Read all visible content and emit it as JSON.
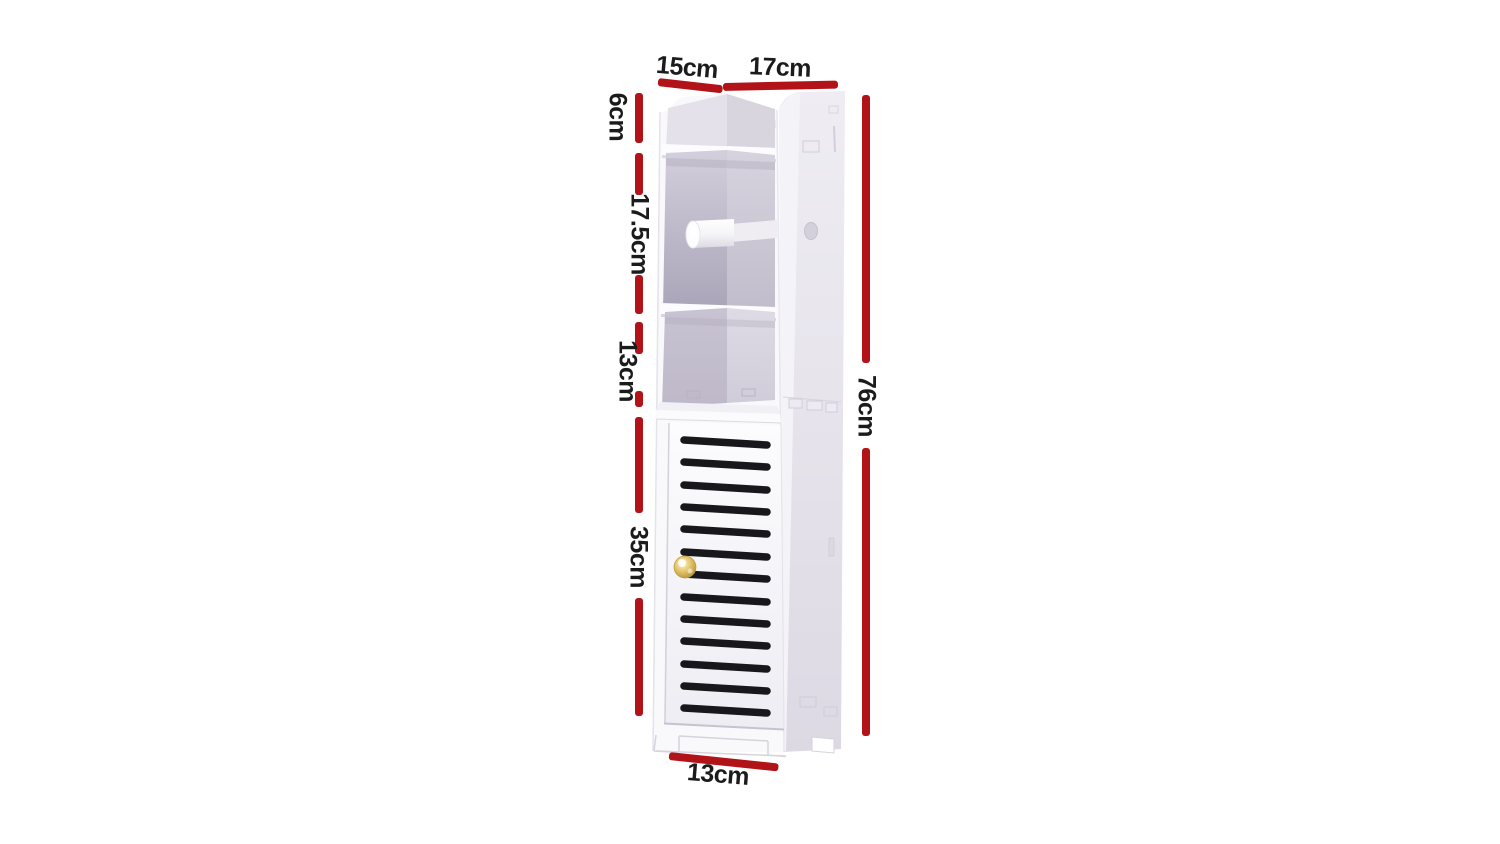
{
  "diagram": {
    "type": "product-dimension-diagram",
    "product_name": "white-slatted-bathroom-toilet-roll-storage-cabinet",
    "background_color": "#ffffff",
    "dimension_line_color": "#b11318",
    "label_text_color": "#1b1b1b",
    "labels": {
      "top_width": "15cm",
      "top_depth": "17cm",
      "top_opening_height": "6cm",
      "roll_compartment_height": "17.5cm",
      "open_shelf_height": "13cm",
      "door_height": "35cm",
      "total_height": "76cm",
      "base_width": "13cm"
    },
    "cabinet": {
      "body_color": "#f9f9fb",
      "side_panel_color": "#e7e5ec",
      "interior_shadow_color": "#aaa4b8",
      "louver_color": "#17171c",
      "louver_count": 13,
      "knob_color": "#d8b54a"
    }
  }
}
